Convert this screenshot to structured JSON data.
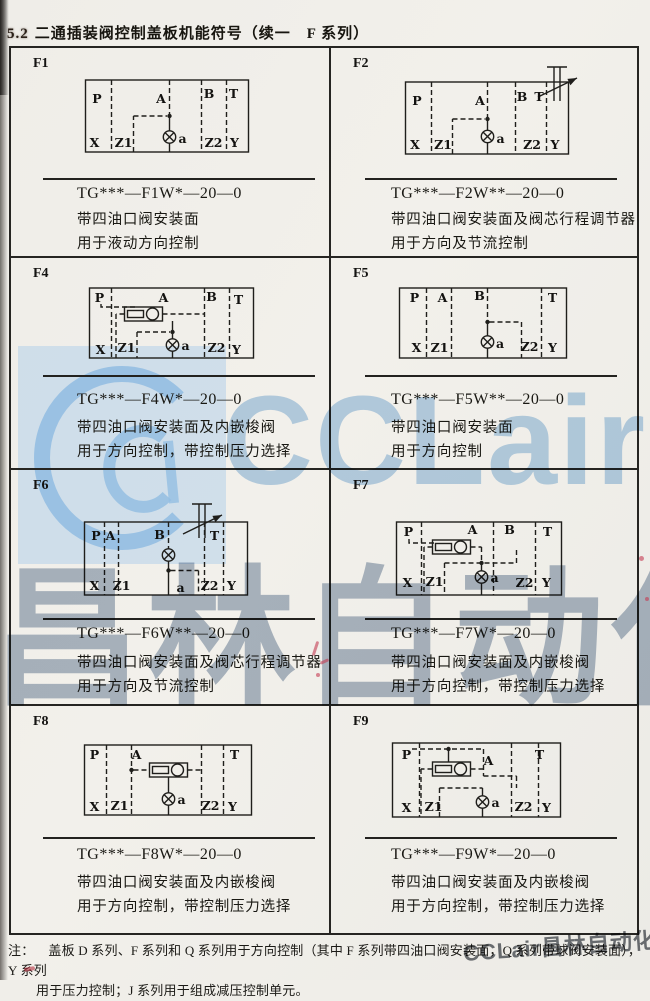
{
  "page": {
    "title_no": "5.2",
    "title_text": "二通插装阀控制盖板机能符号（续一　F 系列）",
    "note_label": "注：",
    "note_line1": "盖板 D 系列、F 系列和 Q 系列用于方向控制（其中 F 系列带四油口阀安装面，Q 系列带球阀安装面），Y 系列",
    "note_line2": "用于压力控制；J 系列用于组成减压控制单元。",
    "watermark_brand": "CCLair",
    "watermark_cn": "昌林自动化",
    "watermark_corner": "CCLair昌林自动化",
    "accent_blue": "#a9cbe9",
    "paper_color": "#f0eee9"
  },
  "cells": [
    {
      "id": "F1",
      "code": "TG***—F1W*—20—0",
      "desc1": "带四油口阀安装面",
      "desc2": "用于液动方向控制",
      "ports": {
        "p": "P",
        "a_top": "A",
        "b": "B",
        "t": "T",
        "x": "X",
        "z1": "Z1",
        "z2": "Z2",
        "y": "Y",
        "pilot": "a"
      }
    },
    {
      "id": "F2",
      "code": "TG***—F2W**—20—0",
      "desc1": "带四油口阀安装面及阀芯行程调节器",
      "desc2": "用于方向及节流控制",
      "ports": {
        "p": "P",
        "a_top": "A",
        "b": "B",
        "t": "T",
        "x": "X",
        "z1": "Z1",
        "z2": "Z2",
        "y": "Y",
        "pilot": "a"
      }
    },
    {
      "id": "F4",
      "code": "TG***—F4W*—20—0",
      "desc1": "带四油口阀安装面及内嵌梭阀",
      "desc2": "用于方向控制，带控制压力选择",
      "ports": {
        "p": "P",
        "a_top": "A",
        "b": "B",
        "t": "T",
        "x": "X",
        "z1": "Z1",
        "z2": "Z2",
        "y": "Y",
        "pilot": "a"
      }
    },
    {
      "id": "F5",
      "code": "TG***—F5W**—20—0",
      "desc1": "带四油口阀安装面",
      "desc2": "用于方向控制",
      "ports": {
        "p": "P",
        "a_top": "A",
        "b": "B",
        "t": "T",
        "x": "X",
        "z1": "Z1",
        "z2": "Z2",
        "y": "Y",
        "pilot": "a"
      }
    },
    {
      "id": "F6",
      "code": "TG***—F6W**—20—0",
      "desc1": "带四油口阀安装面及阀芯行程调节器",
      "desc2": "用于方向及节流控制",
      "ports": {
        "p": "P",
        "a_top": "A",
        "b": "B",
        "t": "T",
        "x": "X",
        "z1": "Z1",
        "z2": "Z2",
        "y": "Y",
        "pilot": "a"
      }
    },
    {
      "id": "F7",
      "code": "TG***—F7W*—20—0",
      "desc1": "带四油口阀安装面及内嵌梭阀",
      "desc2": "用于方向控制，带控制压力选择",
      "ports": {
        "p": "P",
        "a_top": "A",
        "b": "B",
        "t": "T",
        "x": "X",
        "z1": "Z1",
        "z2": "Z2",
        "y": "Y",
        "pilot": "a"
      }
    },
    {
      "id": "F8",
      "code": "TG***—F8W*—20—0",
      "desc1": "带四油口阀安装面及内嵌梭阀",
      "desc2": "用于方向控制，带控制压力选择",
      "ports": {
        "p": "P",
        "a_top": "A",
        "t": "T",
        "x": "X",
        "z1": "Z1",
        "z2": "Z2",
        "y": "Y",
        "pilot": "a"
      }
    },
    {
      "id": "F9",
      "code": "TG***—F9W*—20—0",
      "desc1": "带四油口阀安装面及内嵌梭阀",
      "desc2": "用于方向控制，带控制压力选择",
      "ports": {
        "p": "P",
        "a_top": "A",
        "t": "T",
        "x": "X",
        "z1": "Z1",
        "z2": "Z2",
        "y": "Y",
        "pilot": "a"
      }
    }
  ]
}
